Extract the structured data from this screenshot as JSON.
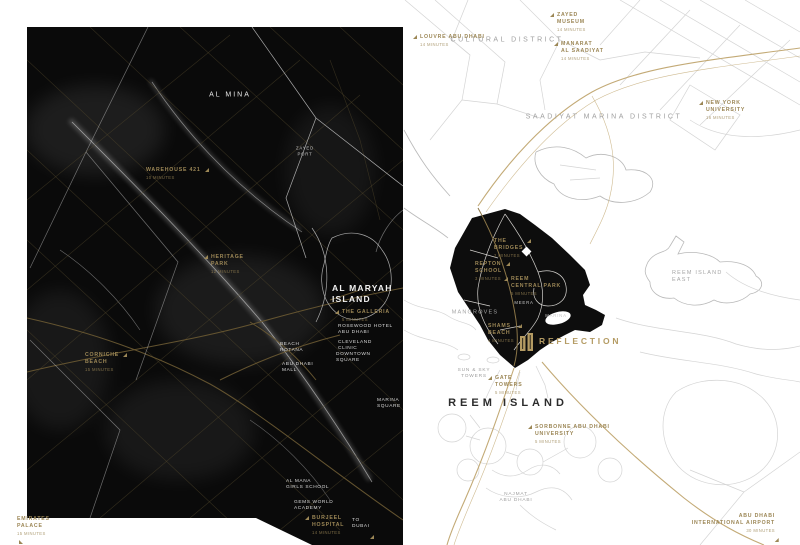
{
  "theme": {
    "gold": "#9c8756",
    "gold-bright": "#b49b63",
    "map_line": "#d4d4d4",
    "inset_bg": "#0a0a0a",
    "island_fill": "#0d0d0d"
  },
  "map_labels": [
    {
      "name": "cultural-district",
      "lines": [
        "CULTURAL DISTRICT"
      ],
      "x": 507,
      "y": 40,
      "cls": "district",
      "align": "c"
    },
    {
      "name": "saadiyat-marina-district",
      "lines": [
        "SAADIYAT MARINA DISTRICT"
      ],
      "x": 604,
      "y": 117,
      "cls": "district",
      "align": "c"
    },
    {
      "name": "reem-island-east",
      "lines": [
        "REEM ISLAND",
        "EAST"
      ],
      "x": 672,
      "y": 270,
      "cls": "district-sm"
    },
    {
      "name": "mangroves",
      "lines": [
        "MANGROVES"
      ],
      "x": 475,
      "y": 313,
      "cls": "district-sm",
      "align": "c"
    },
    {
      "name": "reem-island-title",
      "lines": [
        "REEM ISLAND"
      ],
      "x": 508,
      "y": 403,
      "cls": "reem-title",
      "align": "c"
    },
    {
      "name": "najmat-abu-dhabi",
      "lines": [
        "NAJMAT",
        "ABU DHABI"
      ],
      "x": 516,
      "y": 498,
      "cls": "tiny-gray",
      "align": "c"
    },
    {
      "name": "sun-sky-towers",
      "lines": [
        "SUN & SKY",
        "TOWERS"
      ],
      "x": 474,
      "y": 374,
      "cls": "tiny-gray",
      "align": "c"
    },
    {
      "name": "al-mina",
      "lines": [
        "AL MINA"
      ],
      "x": 230,
      "y": 95,
      "cls": "white-md",
      "align": "c"
    },
    {
      "name": "zayed-port",
      "lines": [
        "ZAYED",
        "PORT"
      ],
      "x": 305,
      "y": 151,
      "cls": "white-xs",
      "align": "c"
    },
    {
      "name": "al-maryah-island",
      "lines": [
        "AL MARYAH",
        "ISLAND"
      ],
      "x": 332,
      "y": 283,
      "cls": "white-lg"
    },
    {
      "name": "the-galleria",
      "lines": [
        "THE GALLERIA"
      ],
      "sub": "5 MINUTES",
      "x": 342,
      "y": 309,
      "cls": "gold",
      "marker": "tl"
    },
    {
      "name": "rosewood-hotel",
      "lines": [
        "ROSEWOOD HOTEL",
        "ABU DHABI"
      ],
      "x": 338,
      "y": 324,
      "cls": "white-sm"
    },
    {
      "name": "cleveland-clinic",
      "lines": [
        "CLEVELAND",
        "CLINIC"
      ],
      "x": 338,
      "y": 340,
      "cls": "white-sm"
    },
    {
      "name": "downtown-square",
      "lines": [
        "DOWNTOWN",
        "SQUARE"
      ],
      "x": 336,
      "y": 352,
      "cls": "white-sm"
    },
    {
      "name": "beach-rotana",
      "lines": [
        "BEACH",
        "ROTANA"
      ],
      "x": 280,
      "y": 342,
      "cls": "white-sm"
    },
    {
      "name": "abu-dhabi-mall",
      "lines": [
        "ABU DHABI",
        "MALL"
      ],
      "x": 282,
      "y": 362,
      "cls": "white-sm"
    },
    {
      "name": "marina-square",
      "lines": [
        "MARINA",
        "SQUARE"
      ],
      "x": 377,
      "y": 398,
      "cls": "white-sm"
    },
    {
      "name": "al-mana-girls-school",
      "lines": [
        "AL MANA",
        "GIRLS SCHOOL"
      ],
      "x": 286,
      "y": 479,
      "cls": "white-sm"
    },
    {
      "name": "gems-world-academy",
      "lines": [
        "GEMS WORLD",
        "ACADEMY"
      ],
      "x": 294,
      "y": 500,
      "cls": "white-sm"
    },
    {
      "name": "to-dubai",
      "lines": [
        "TO",
        "DUBAI"
      ],
      "x": 352,
      "y": 518,
      "cls": "white-sm",
      "marker": "br"
    },
    {
      "name": "warehouse-421",
      "lines": [
        "WAREHOUSE 421"
      ],
      "sub": "10 MINUTES",
      "x": 146,
      "y": 167,
      "cls": "gold",
      "marker": "tr"
    },
    {
      "name": "heritage-park",
      "lines": [
        "HERITAGE",
        "PARK"
      ],
      "sub": "12 MINUTES",
      "x": 211,
      "y": 254,
      "cls": "gold",
      "marker": "tl"
    },
    {
      "name": "corniche-beach",
      "lines": [
        "CORNICHE",
        "BEACH"
      ],
      "sub": "15 MINUTES",
      "x": 85,
      "y": 352,
      "cls": "gold",
      "marker": "tr"
    },
    {
      "name": "burjeel-hospital",
      "lines": [
        "BURJEEL",
        "HOSPITAL"
      ],
      "sub": "14 MINUTES",
      "x": 312,
      "y": 515,
      "cls": "gold",
      "marker": "tl"
    },
    {
      "name": "emirates-palace",
      "lines": [
        "EMIRATES",
        "PALACE"
      ],
      "sub": "15 MINUTES",
      "x": 17,
      "y": 516,
      "cls": "gold",
      "marker": "bl"
    },
    {
      "name": "louvre-abu-dhabi",
      "lines": [
        "LOUVRE ABU DHABI"
      ],
      "sub": "14 MINUTES",
      "x": 420,
      "y": 34,
      "cls": "gold",
      "marker": "tl"
    },
    {
      "name": "zayed-museum",
      "lines": [
        "ZAYED",
        "MUSEUM"
      ],
      "sub": "14 MINUTES",
      "x": 557,
      "y": 12,
      "cls": "gold",
      "marker": "tl"
    },
    {
      "name": "manarat-al-saadiyat",
      "lines": [
        "MANARAT",
        "AL SAADIYAT"
      ],
      "sub": "14 MINUTES",
      "x": 561,
      "y": 41,
      "cls": "gold",
      "marker": "tl"
    },
    {
      "name": "new-york-university",
      "lines": [
        "NEW YORK",
        "UNIVERSITY"
      ],
      "sub": "16 MINUTES",
      "x": 706,
      "y": 100,
      "cls": "gold",
      "marker": "tl"
    },
    {
      "name": "the-bridges",
      "lines": [
        "THE",
        "BRIDGES"
      ],
      "sub": "2 MINUTES",
      "x": 494,
      "y": 238,
      "cls": "gold",
      "marker": "tr"
    },
    {
      "name": "repton-school",
      "lines": [
        "REPTON",
        "SCHOOL"
      ],
      "sub": "3 MINUTES",
      "x": 475,
      "y": 261,
      "cls": "gold",
      "marker": "tr"
    },
    {
      "name": "reem-central-park",
      "lines": [
        "REEM",
        "CENTRAL PARK"
      ],
      "sub": "5 MINUTES",
      "x": 511,
      "y": 276,
      "cls": "gold",
      "marker": "tl"
    },
    {
      "name": "shams-beach",
      "lines": [
        "SHAMS",
        "BEACH"
      ],
      "sub": "4 MINUTES",
      "x": 488,
      "y": 323,
      "cls": "gold",
      "marker": "tr"
    },
    {
      "name": "gate-towers",
      "lines": [
        "GATE",
        "TOWERS"
      ],
      "sub": "5 MINUTES",
      "x": 495,
      "y": 375,
      "cls": "gold",
      "marker": "tl"
    },
    {
      "name": "sorbonne-university",
      "lines": [
        "SORBONNE ABU DHABI",
        "UNIVERSITY"
      ],
      "sub": "5 MINUTES",
      "x": 535,
      "y": 424,
      "cls": "gold",
      "marker": "tl"
    },
    {
      "name": "abu-dhabi-international-airport",
      "lines": [
        "ABU DHABI",
        "INTERNATIONAL AIRPORT"
      ],
      "sub": "30 MINUTES",
      "x": 775,
      "y": 513,
      "cls": "gold",
      "align": "r",
      "marker": "br"
    },
    {
      "name": "reflection-brand",
      "lines": [
        "REFLECTION"
      ],
      "x": 539,
      "y": 336,
      "cls": "brand"
    },
    {
      "name": "meera",
      "lines": [
        "MEERA"
      ],
      "x": 524,
      "y": 303,
      "cls": "white-xs",
      "align": "c"
    },
    {
      "name": "marina-area",
      "lines": [
        "MARINA"
      ],
      "x": 556,
      "y": 316,
      "cls": "white-xs",
      "align": "c"
    }
  ]
}
